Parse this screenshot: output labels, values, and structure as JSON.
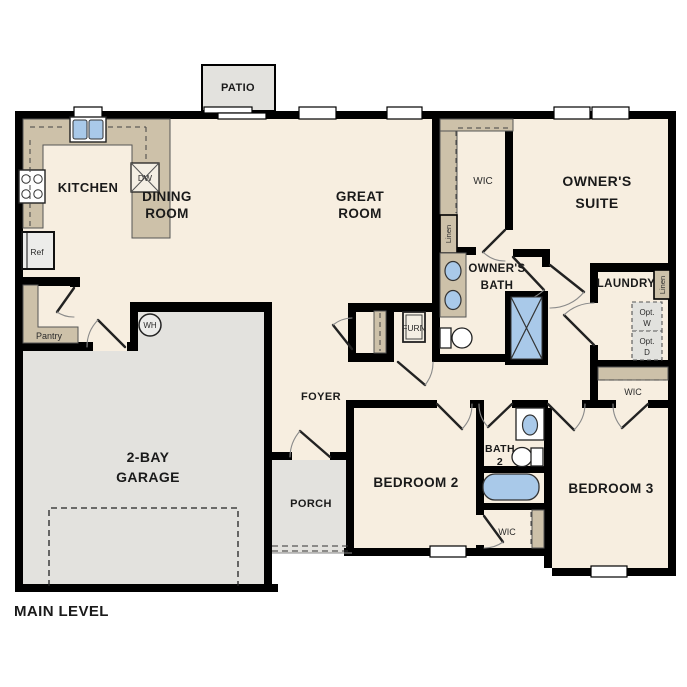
{
  "plan_title": "MAIN LEVEL",
  "labels": {
    "patio": "PATIO",
    "kitchen": "KITCHEN",
    "dining_room": [
      "DINING",
      "ROOM"
    ],
    "great_room": [
      "GREAT",
      "ROOM"
    ],
    "owners_suite": [
      "OWNER'S",
      "SUITE"
    ],
    "owners_bath": [
      "OWNER'S",
      "BATH"
    ],
    "wic_owner": "WIC",
    "wic_hall": "WIC",
    "wic_bedroom2": "WIC",
    "laundry": "LAUNDRY",
    "linen_wic": "Linen",
    "linen_laundry": "Linen",
    "opt_washer": [
      "Opt.",
      "W"
    ],
    "opt_dryer": [
      "Opt.",
      "D"
    ],
    "furnace": "FURN",
    "water_heater": "WH",
    "pantry": "Pantry",
    "refrigerator": "Ref",
    "dishwasher": "DW",
    "foyer": "FOYER",
    "porch": "PORCH",
    "garage": [
      "2-BAY",
      "GARAGE"
    ],
    "bedroom2": "BEDROOM 2",
    "bedroom3": "BEDROOM 3",
    "bath2": [
      "BATH",
      "2"
    ]
  },
  "colors": {
    "floor": "#f7eee0",
    "outdoor_concrete": "#e3e2de",
    "cabinetry_tan": "#cdc1a9",
    "plumbing_blue": "#a9c9e9",
    "wall": "#000000",
    "background": "#ffffff"
  }
}
